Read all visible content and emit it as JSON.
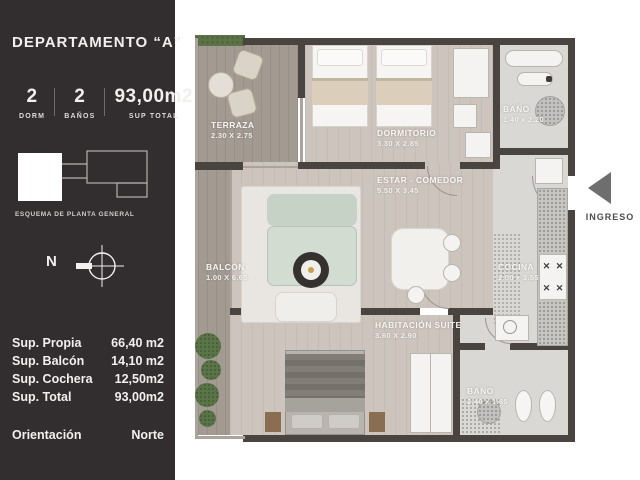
{
  "sidebar": {
    "title": "DEPARTAMENTO  “A”",
    "stats": [
      {
        "value": "2",
        "label": "DORM"
      },
      {
        "value": "2",
        "label": "BAÑOS"
      },
      {
        "value": "93,00m2",
        "label": "SUP TOTAL"
      }
    ],
    "schematic_caption": "ESQUEMA DE PLANTA GENERAL",
    "compass_label": "N",
    "areas": [
      {
        "label": "Sup. Propia",
        "value": "66,40 m2"
      },
      {
        "label": "Sup. Balcón",
        "value": "14,10 m2"
      },
      {
        "label": "Sup. Cochera",
        "value": "12,50m2"
      },
      {
        "label": "Sup. Total",
        "value": "93,00m2"
      }
    ],
    "orientation": {
      "label": "Orientación",
      "value": "Norte"
    }
  },
  "plan": {
    "rooms": [
      {
        "name": "TERRAZA",
        "dims": "2.30 X 2.75"
      },
      {
        "name": "DORMITORIO",
        "dims": "3.30 X 2.85"
      },
      {
        "name": "BAÑO",
        "dims": "1.40 x 2.20"
      },
      {
        "name": "ESTAR - COMEDOR",
        "dims": "5.50 X 3.45"
      },
      {
        "name": "BALCÓN",
        "dims": "1.00 X 6.65"
      },
      {
        "name": "COCINA",
        "dims": "2.00 x 3.55"
      },
      {
        "name": "HABITACIÓN SUITE",
        "dims": "3.60 X 2.90"
      },
      {
        "name": "BAÑO",
        "dims": "2.40 x 1.85"
      }
    ],
    "entrance_label": "INGRESO"
  },
  "icons": {
    "stove_burner": "✕"
  },
  "colors": {
    "sidebar_bg": "#322e2f",
    "wall": "#49443f",
    "wood_floor": "#a39b92",
    "interior_floor": "#cdc5bd",
    "tile_floor": "#d9d8d5",
    "sofa": "#c7d2c7",
    "text_light": "#f2f0ee",
    "entrance_arrow": "#6e6e6e"
  }
}
